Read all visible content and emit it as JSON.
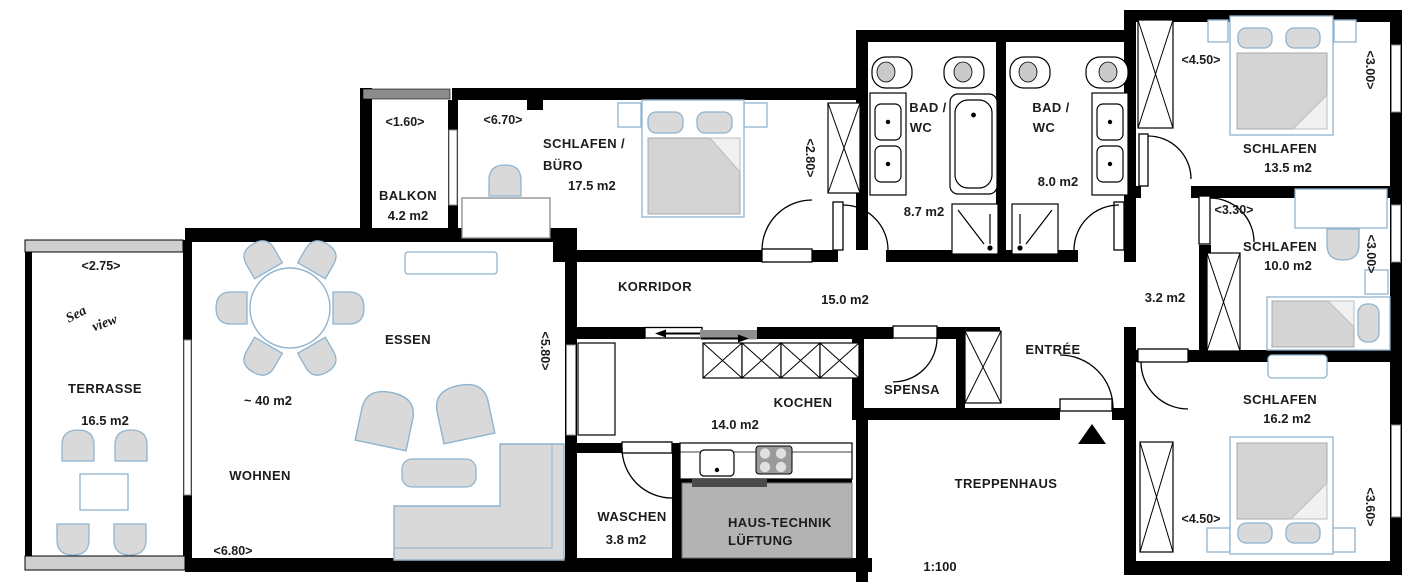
{
  "plan": {
    "scale": "1:100",
    "rooms": {
      "balkon": {
        "name": "BALKON",
        "area": "4.2 m2",
        "width": "<1.60>"
      },
      "schlafen_buero": {
        "name1": "SCHLAFEN /",
        "name2": "BÜRO",
        "area": "17.5 m2",
        "width": "<6.70>",
        "depth": "<2.80>"
      },
      "bad_1": {
        "name1": "BAD /",
        "name2": "WC",
        "area": "8.7 m2"
      },
      "bad_2": {
        "name1": "BAD /",
        "name2": "WC",
        "area": "8.0 m2"
      },
      "schlafen_13": {
        "name": "SCHLAFEN",
        "area": "13.5 m2",
        "width": "<4.50>",
        "depth": "<3.00>"
      },
      "schlafen_10": {
        "name": "SCHLAFEN",
        "area": "10.0 m2",
        "width": "<3.30>",
        "depth": "<3.00>"
      },
      "schlafen_16": {
        "name": "SCHLAFEN",
        "area": "16.2 m2",
        "width": "<4.50>",
        "depth": "<3.60>"
      },
      "flur": {
        "area": "3.2 m2"
      },
      "korridor": {
        "name": "KORRIDOR",
        "area": "15.0 m2"
      },
      "kochen": {
        "name": "KOCHEN",
        "area": "14.0 m2"
      },
      "spensa": {
        "name": "SPENSA"
      },
      "entree": {
        "name": "ENTRÉE"
      },
      "waschen": {
        "name": "WASCHEN",
        "area": "3.8 m2"
      },
      "haus_technik": {
        "name1": "HAUS-TECHNIK",
        "name2": "LÜFTUNG"
      },
      "treppenhaus": {
        "name": "TREPPENHAUS"
      },
      "terrasse": {
        "name": "TERRASSE",
        "area": "16.5 m2",
        "width": "<2.75>",
        "note1": "Sea",
        "note2": "view"
      },
      "essen": {
        "name": "ESSEN"
      },
      "wohnen": {
        "name": "WOHNEN",
        "area": "~ 40 m2",
        "width": "<6.80>",
        "depth": "<5.80>"
      }
    },
    "colors": {
      "wall": "#000000",
      "furniture_fill": "#d9d9d9",
      "furniture_stroke": "#8fb4cf",
      "tech_room_fill": "#b3b3b3",
      "railing_fill": "#cfcfcf",
      "sliding_panel": "#8f8f8f"
    }
  }
}
